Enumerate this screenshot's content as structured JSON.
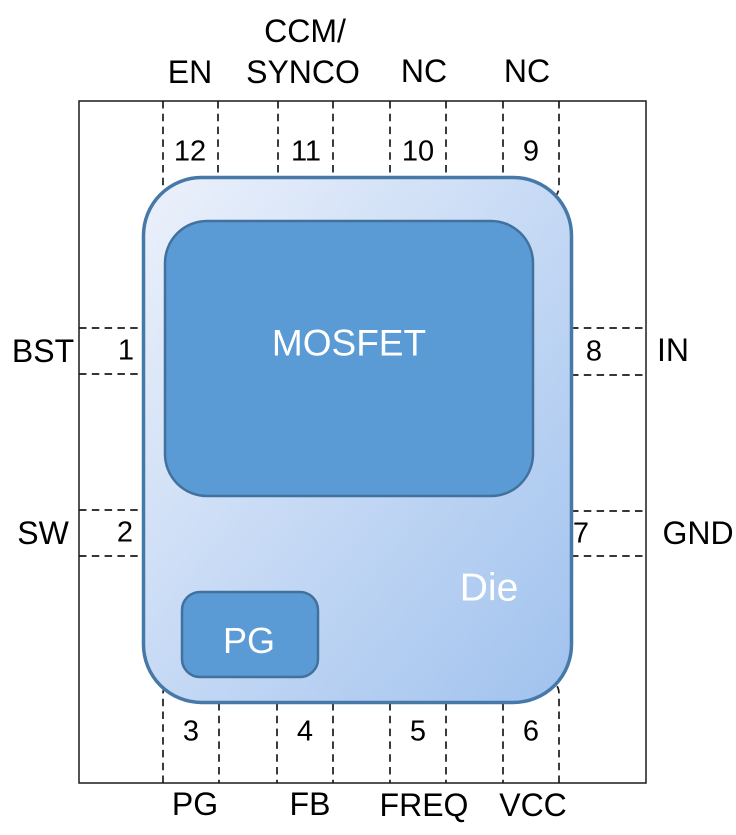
{
  "diagram": {
    "description": "12-pin IC package pinout with internal die, MOSFET and PG blocks",
    "blocks": {
      "mosfet_label": "MOSFET",
      "die_label": "Die",
      "pg_label": "PG"
    },
    "pins": {
      "pin1": {
        "number": "1",
        "label": "BST",
        "side": "left"
      },
      "pin2": {
        "number": "2",
        "label": "SW",
        "side": "left"
      },
      "pin3": {
        "number": "3",
        "label": "PG",
        "side": "bottom"
      },
      "pin4": {
        "number": "4",
        "label": "FB",
        "side": "bottom"
      },
      "pin5": {
        "number": "5",
        "label": "FREQ",
        "side": "bottom"
      },
      "pin6": {
        "number": "6",
        "label": "VCC",
        "side": "bottom"
      },
      "pin7": {
        "number": "7",
        "label": "GND",
        "side": "right"
      },
      "pin8": {
        "number": "8",
        "label": "IN",
        "side": "right"
      },
      "pin9": {
        "number": "9",
        "label": "NC",
        "side": "top"
      },
      "pin10": {
        "number": "10",
        "label": "NC",
        "side": "top"
      },
      "pin11": {
        "number": "11",
        "label_line1": "CCM/",
        "label_line2": "SYNCO",
        "side": "top"
      },
      "pin12": {
        "number": "12",
        "label": "EN",
        "side": "top"
      }
    },
    "colors": {
      "block_fill": "#5b9bd5",
      "block_stroke": "#41719c",
      "die_stroke": "#4678a8",
      "die_gradient_start": "#ecf1fb",
      "die_gradient_end": "#a0c2ee",
      "outline": "#1a1a1a",
      "label_text": "#000000",
      "block_text": "#ffffff"
    }
  }
}
